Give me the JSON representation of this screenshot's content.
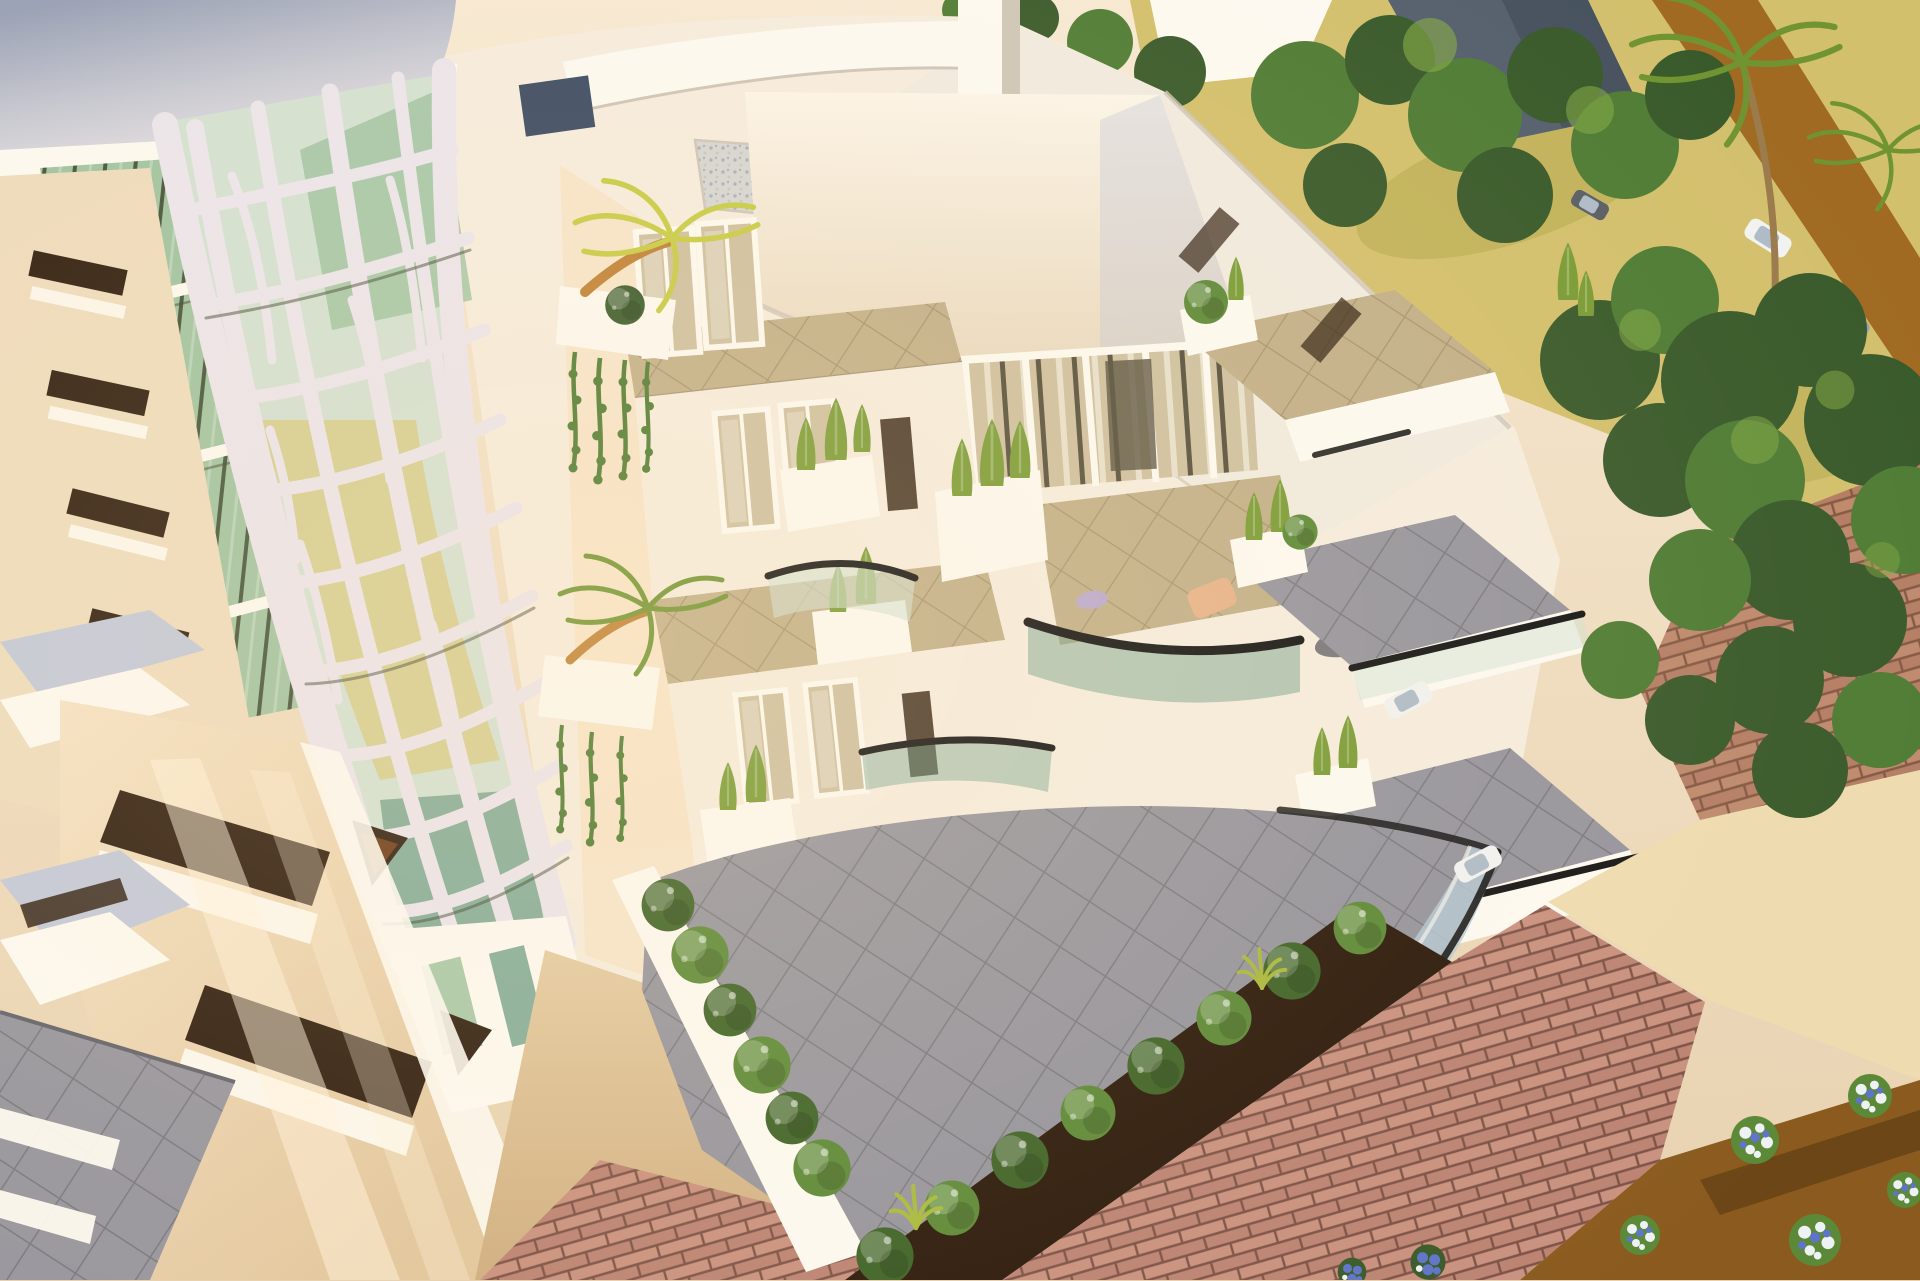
{
  "image": {
    "kind": "3d-architectural-exterior-render",
    "view": "aerial-corner-view",
    "lighting": "warm-late-afternoon-sun",
    "alt": "Aerial 3D architectural rendering of a modern white apartment building at sunset: a curved tower wrapped in an organic white lattice over green glass on the left, stepped balconies with black-railed glass balustrades and cypress planters in the center, terraced units descending to the right beside a dark tree grove, white roof terraces with a gravel bed above, and a landscaped plaza of pink brick paving, round clipped shrubs, tan paths and flower beds below."
  },
  "palette": {
    "white": "#ffffff",
    "black": "#000000",
    "bgTop": "#f7e9d4",
    "bgBottom": "#e7d1af",
    "towerA": "#97a0b6",
    "towerB": "#c6c8d3",
    "towerC": "#e7e4e8",
    "brightWhite": "#fdfaf2",
    "warmWhite": "#f6eddf",
    "roofWhite": "#f1ebdf",
    "parapetShadow": "#cfc6b8",
    "bayA": "#fcf5e9",
    "bayB": "#e9d9c0",
    "creamA": "#f5e3c6",
    "creamB": "#e2c69d",
    "creamWall": "#eedcbd",
    "peachWall": "#f7e4ca",
    "shadowBlue": "#c2c8da",
    "latticeWhite": "#ebe5ed",
    "latticeDark": "#3a402e",
    "glassGreen": "#9fc3a1",
    "glassTeal": "#6f9f8b",
    "glassGold": "#d5c77c",
    "glassPale": "#d2e1d3",
    "glassTan": "#cec0a0",
    "frameDark": "#56503e",
    "mullionDark": "#42533a",
    "windowSlot": "#2e1c0e",
    "slotBrown": "#6b3a18",
    "navyPane": "#3b4a63",
    "tileGray": "#96959e",
    "tileGrayDark": "#63636c",
    "tileKhaki": "#c2b089",
    "tileEdge": "#a69577",
    "brickLight": "#c9917f",
    "brickDark": "#bc8373",
    "brickLine": "#7d5246",
    "pathTanA": "#e4cba2",
    "pathTanB": "#cfae80",
    "plazaCream": "#eedcb0",
    "pathBrown": "#a06a22",
    "soilDark": "#2b190b",
    "soilBrown": "#8a5a1e",
    "bushDark": "#3e6327",
    "bushMid": "#5c8937",
    "bushLight": "#85ab45",
    "bushYellow": "#a9b93d",
    "treeDark": "#395a2b",
    "treeMid": "#4f7c35",
    "cypress": "#7a9c36",
    "vineGreen": "#4c7b31",
    "trunkOrange": "#bf8034",
    "palmYellow": "#c6cb45",
    "palmGreen": "#6f9431",
    "palmTrunk": "#9b7b4c",
    "terrainYellow": "#d3c06d",
    "terrainOlive": "#b4a84f",
    "railBlack": "#161616",
    "glassBlue": "#b6c9d6",
    "roofGravel": "#d6d6d4",
    "gravelDotA": "#a8b0ba",
    "gravelDotB": "#c8c6c0",
    "houseRoofA": "#55606e",
    "houseRoofB": "#47525f",
    "carWhite": "#f2f2f2",
    "carGray": "#9aa0a8",
    "carDark": "#5a5f66",
    "carGlass": "#aebcc8",
    "flowerWhite": "#eef2f4",
    "flowerBlue": "#5f74c8",
    "chairPeach": "#e7b38a",
    "cushionLav": "#b9a8d8",
    "glowWarm": "#ffe2b0",
    "sunStreak": "#fff4dd"
  },
  "scene": {
    "regions": [
      {
        "name": "lattice-tower",
        "note": "curved white tower corner with organic lattice screen over green and gold glass"
      },
      {
        "name": "tower-cap",
        "note": "smooth blue-gray cylindrical cap at top left"
      },
      {
        "name": "west-wing",
        "note": "cream facade with dark diagonal window slots and white balcony ledges"
      },
      {
        "name": "roof-terrace",
        "note": "white parapets, gravel bed and elevator core on the roof"
      },
      {
        "name": "curved-bay",
        "note": "pearl white curved bay volume over a band of glazed doors"
      },
      {
        "name": "courtyard-balconies",
        "note": "stacked balconies with cypress planters, palm trees, hanging vines and black-railed curved glass balustrades"
      },
      {
        "name": "right-terraces",
        "note": "terraced units stepping down with gray tile floors and planters"
      },
      {
        "name": "ground-terrace",
        "note": "large gray diamond-tiled terrace bounded by a curved glass balustrade and a hedge"
      },
      {
        "name": "garden-plaza",
        "note": "pink brick paving, cream stone paths, dark soil strip with a row of round clipped shrubs"
      },
      {
        "name": "flower-beds",
        "note": "brown planting beds with white and blue flower clusters"
      },
      {
        "name": "tree-grove",
        "note": "dense dark green trees and palms on the right side"
      },
      {
        "name": "upper-street",
        "note": "sandy yellow ground, brown access road, neighbor roof and parked cars at top right"
      }
    ]
  }
}
